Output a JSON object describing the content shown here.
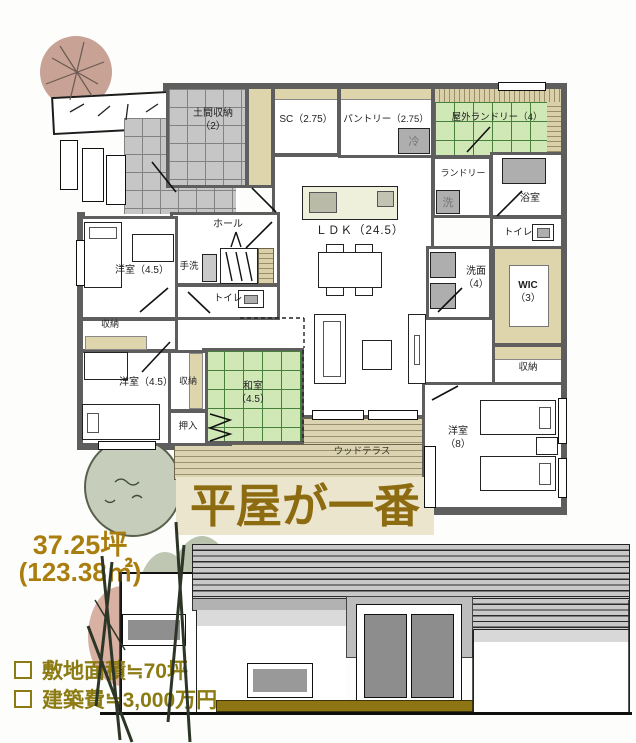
{
  "title": {
    "text": "平屋が一番"
  },
  "area": {
    "tsubo": "37.25坪",
    "sqm": "(123.38㎡)"
  },
  "notes": [
    {
      "text": "敷地面積≒70坪"
    },
    {
      "text": "建築費≒3,000万円"
    }
  ],
  "plan": {
    "rooms": {
      "doma": {
        "label": "土間収納",
        "size": "（2）"
      },
      "sc": {
        "label": "SC（2.75）"
      },
      "pantry": {
        "label": "パントリー（2.75）"
      },
      "outdoor_laundry": {
        "label": "屋外ランドリー（4）"
      },
      "laundry": {
        "label": "ランドリー"
      },
      "bath": {
        "label": "浴室"
      },
      "toilet_right": {
        "label": "トイレ"
      },
      "washroom": {
        "label": "洗面",
        "size": "（4）"
      },
      "wic": {
        "label": "WIC",
        "size": "（3）"
      },
      "storage_right": {
        "label": "収納"
      },
      "bedroom_right": {
        "label": "洋室",
        "size": "（8）"
      },
      "ldk": {
        "label": "ＬＤＫ（24.5）"
      },
      "hall": {
        "label": "ホール"
      },
      "handwash": {
        "label": "手洗"
      },
      "toilet_left": {
        "label": "トイレ"
      },
      "bedroom_nw": {
        "label": "洋室（4.5）"
      },
      "storage_nw": {
        "label": "収納"
      },
      "bedroom_sw": {
        "label": "洋室（4.5）"
      },
      "storage_center": {
        "label": "収納"
      },
      "washitsu": {
        "label": "和室",
        "size": "（4.5）"
      },
      "oshiire": {
        "label": "押入"
      },
      "wood_terrace": {
        "label": "ウッドテラス"
      },
      "fridge": {
        "label": "冷"
      },
      "washer": {
        "label": "洗"
      }
    }
  },
  "colors": {
    "wall": "#5e5e5e",
    "title_gold": "#8d6b10",
    "area_gold": "#aa7e0e",
    "note_olive": "#8c7b12",
    "tatami_green": "#d0e7b6",
    "tile_gray": "#c6c6c6",
    "closet_cream": "#ded5ad",
    "base_strip_olive": "#8c7512"
  }
}
